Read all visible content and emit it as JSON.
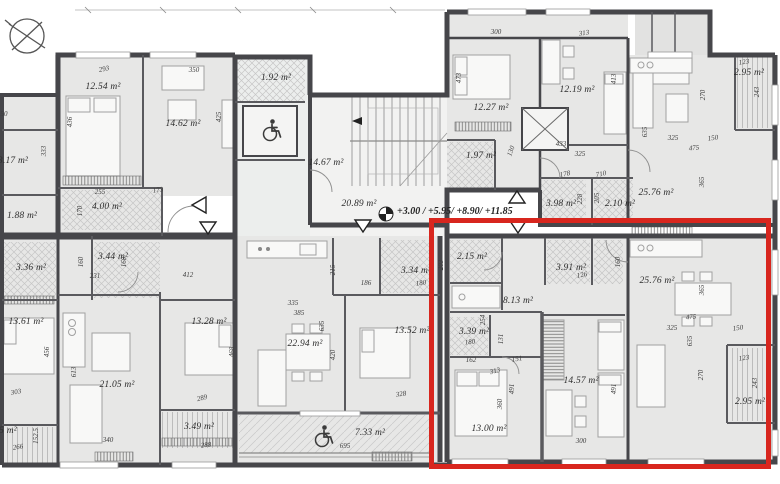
{
  "drawing": {
    "type": "residential-floor-plan",
    "highlight_color": "#d8261e",
    "wall_color": "#46464a",
    "room_fill": "#e7e7e6",
    "icons": [
      "north-compass-icon",
      "level-datum-icon",
      "wheelchair-icon",
      "entry-arrow-icon",
      "elevator-cross-icon"
    ]
  },
  "annotations": {
    "levels": "+3.00 / +5.95/ +8.90/ +11.85"
  },
  "room_labels": [
    {
      "t": "12.54 m²",
      "x": 103,
      "y": 87
    },
    {
      "t": "14.62 m²",
      "x": 183,
      "y": 124
    },
    {
      "t": "1.92 m²",
      "x": 276,
      "y": 78
    },
    {
      "t": "14.67 m²",
      "x": 326,
      "y": 163
    },
    {
      "t": "20.89 m²",
      "x": 359,
      "y": 204
    },
    {
      "t": "12.27 m²",
      "x": 491,
      "y": 108
    },
    {
      "t": "12.19 m²",
      "x": 577,
      "y": 90
    },
    {
      "t": "1.97 m²",
      "x": 481,
      "y": 156
    },
    {
      "t": "25.76 m²",
      "x": 656,
      "y": 193
    },
    {
      "t": "2.95 m²",
      "x": 749,
      "y": 73
    },
    {
      "t": "3.98 m²",
      "x": 561,
      "y": 204
    },
    {
      "t": "2.10 m²",
      "x": 620,
      "y": 204
    },
    {
      "t": "3.17 m²",
      "x": 13,
      "y": 161
    },
    {
      "t": "1.88 m²",
      "x": 22,
      "y": 216
    },
    {
      "t": "4.00 m²",
      "x": 107,
      "y": 207
    },
    {
      "t": "3.36 m²",
      "x": 31,
      "y": 268
    },
    {
      "t": "3.44 m²",
      "x": 113,
      "y": 257
    },
    {
      "t": "13.61 m²",
      "x": 26,
      "y": 322
    },
    {
      "t": "21.05 m²",
      "x": 117,
      "y": 385
    },
    {
      "t": "13.28 m²",
      "x": 209,
      "y": 322
    },
    {
      "t": "3.49 m²",
      "x": 199,
      "y": 427
    },
    {
      "t": "22.94 m²",
      "x": 305,
      "y": 344
    },
    {
      "t": "3.34 m²",
      "x": 416,
      "y": 271
    },
    {
      "t": "13.52 m²",
      "x": 412,
      "y": 331
    },
    {
      "t": "7.33 m²",
      "x": 370,
      "y": 433
    },
    {
      "t": "5 m²",
      "x": 8,
      "y": 431
    },
    {
      "t": "2.15 m²",
      "x": 472,
      "y": 257
    },
    {
      "t": "3.91 m²",
      "x": 571,
      "y": 268
    },
    {
      "t": "8.13 m²",
      "x": 518,
      "y": 301
    },
    {
      "t": "3.39 m²",
      "x": 474,
      "y": 332
    },
    {
      "t": "13.00 m²",
      "x": 489,
      "y": 429
    },
    {
      "t": "14.57 m²",
      "x": 581,
      "y": 381
    },
    {
      "t": "25.76 m²",
      "x": 657,
      "y": 281
    },
    {
      "t": "2.95 m²",
      "x": 750,
      "y": 402
    }
  ],
  "dim_labels": [
    {
      "t": "293",
      "x": 104,
      "y": 69,
      "r": -12
    },
    {
      "t": "350",
      "x": 194,
      "y": 70,
      "r": 0
    },
    {
      "t": "436",
      "x": 70,
      "y": 122,
      "r": -90
    },
    {
      "t": "425",
      "x": 219,
      "y": 117,
      "r": -90
    },
    {
      "t": "333",
      "x": 44,
      "y": 151,
      "r": -90
    },
    {
      "t": "50",
      "x": 4,
      "y": 114,
      "r": 0
    },
    {
      "t": "255",
      "x": 100,
      "y": 192,
      "r": 0
    },
    {
      "t": "173",
      "x": 158,
      "y": 190,
      "r": -8
    },
    {
      "t": "170",
      "x": 80,
      "y": 211,
      "r": -90
    },
    {
      "t": "231",
      "x": 95,
      "y": 276,
      "r": 0
    },
    {
      "t": "160",
      "x": 81,
      "y": 262,
      "r": -90
    },
    {
      "t": "160",
      "x": 124,
      "y": 262,
      "r": -90
    },
    {
      "t": "412",
      "x": 188,
      "y": 275,
      "r": 0
    },
    {
      "t": "303",
      "x": 16,
      "y": 392,
      "r": -10
    },
    {
      "t": "456",
      "x": 47,
      "y": 352,
      "r": -90
    },
    {
      "t": "613",
      "x": 74,
      "y": 372,
      "r": -90
    },
    {
      "t": "340",
      "x": 108,
      "y": 440,
      "r": 0
    },
    {
      "t": "266",
      "x": 18,
      "y": 447,
      "r": -8
    },
    {
      "t": "152.5",
      "x": 36,
      "y": 436,
      "r": -90
    },
    {
      "t": "289",
      "x": 202,
      "y": 398,
      "r": -15
    },
    {
      "t": "288",
      "x": 206,
      "y": 445,
      "r": -5
    },
    {
      "t": "335",
      "x": 293,
      "y": 303,
      "r": 0
    },
    {
      "t": "385",
      "x": 299,
      "y": 313,
      "r": 0
    },
    {
      "t": "635",
      "x": 322,
      "y": 326,
      "r": -90
    },
    {
      "t": "420",
      "x": 333,
      "y": 355,
      "r": -90
    },
    {
      "t": "215",
      "x": 333,
      "y": 270,
      "r": -90
    },
    {
      "t": "186",
      "x": 366,
      "y": 283,
      "r": 0
    },
    {
      "t": "180",
      "x": 421,
      "y": 283,
      "r": -8
    },
    {
      "t": "203",
      "x": 441,
      "y": 265,
      "r": -90
    },
    {
      "t": "328",
      "x": 401,
      "y": 394,
      "r": -8
    },
    {
      "t": "695",
      "x": 345,
      "y": 446,
      "r": 0
    },
    {
      "t": "468",
      "x": 232,
      "y": 352,
      "r": -90
    },
    {
      "t": "300",
      "x": 496,
      "y": 32,
      "r": 0
    },
    {
      "t": "313",
      "x": 584,
      "y": 33,
      "r": -8
    },
    {
      "t": "473",
      "x": 459,
      "y": 78,
      "r": -90
    },
    {
      "t": "413",
      "x": 614,
      "y": 79,
      "r": -90
    },
    {
      "t": "433",
      "x": 561,
      "y": 144,
      "r": 0
    },
    {
      "t": "325",
      "x": 580,
      "y": 154,
      "r": 0
    },
    {
      "t": "130",
      "x": 511,
      "y": 151,
      "r": -70
    },
    {
      "t": "178",
      "x": 565,
      "y": 174,
      "r": -12
    },
    {
      "t": "710",
      "x": 601,
      "y": 174,
      "r": -12
    },
    {
      "t": "228",
      "x": 580,
      "y": 199,
      "r": -90
    },
    {
      "t": "205",
      "x": 597,
      "y": 198,
      "r": -90
    },
    {
      "t": "123",
      "x": 744,
      "y": 62,
      "r": -8
    },
    {
      "t": "243",
      "x": 757,
      "y": 92,
      "r": -90
    },
    {
      "t": "270",
      "x": 703,
      "y": 95,
      "r": -90
    },
    {
      "t": "635",
      "x": 645,
      "y": 132,
      "r": -90
    },
    {
      "t": "325",
      "x": 673,
      "y": 138,
      "r": 0
    },
    {
      "t": "150",
      "x": 713,
      "y": 138,
      "r": -8
    },
    {
      "t": "475",
      "x": 694,
      "y": 148,
      "r": -5
    },
    {
      "t": "365",
      "x": 702,
      "y": 182,
      "r": -90
    },
    {
      "t": "126",
      "x": 582,
      "y": 275,
      "r": -10
    },
    {
      "t": "160",
      "x": 618,
      "y": 262,
      "r": -90
    },
    {
      "t": "254",
      "x": 483,
      "y": 320,
      "r": -90
    },
    {
      "t": "180",
      "x": 470,
      "y": 342,
      "r": -5
    },
    {
      "t": "162",
      "x": 471,
      "y": 360,
      "r": 0
    },
    {
      "t": "131",
      "x": 501,
      "y": 339,
      "r": -90
    },
    {
      "t": "151",
      "x": 517,
      "y": 359,
      "r": -10
    },
    {
      "t": "313",
      "x": 495,
      "y": 371,
      "r": -15
    },
    {
      "t": "491",
      "x": 512,
      "y": 389,
      "r": -90
    },
    {
      "t": "360",
      "x": 500,
      "y": 404,
      "r": -90
    },
    {
      "t": "300",
      "x": 581,
      "y": 441,
      "r": 0
    },
    {
      "t": "491",
      "x": 614,
      "y": 389,
      "r": -90
    },
    {
      "t": "365",
      "x": 702,
      "y": 290,
      "r": -90
    },
    {
      "t": "475",
      "x": 691,
      "y": 317,
      "r": -5
    },
    {
      "t": "325",
      "x": 672,
      "y": 328,
      "r": 0
    },
    {
      "t": "150",
      "x": 738,
      "y": 328,
      "r": -8
    },
    {
      "t": "635",
      "x": 690,
      "y": 341,
      "r": -90
    },
    {
      "t": "270",
      "x": 701,
      "y": 375,
      "r": -90
    },
    {
      "t": "123",
      "x": 744,
      "y": 358,
      "r": -8
    },
    {
      "t": "243",
      "x": 755,
      "y": 383,
      "r": -90
    }
  ]
}
